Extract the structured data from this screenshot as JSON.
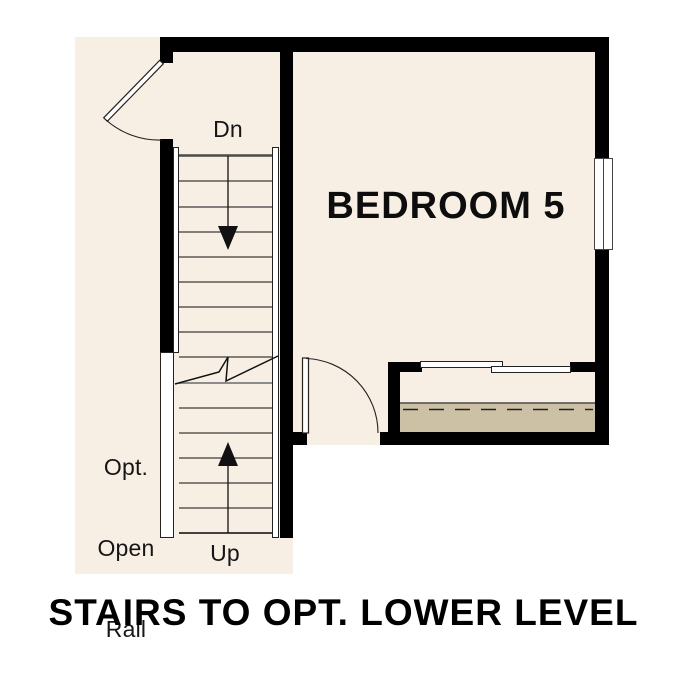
{
  "labels": {
    "bedroom": "BEDROOM 5",
    "down": "Dn",
    "up": "Up",
    "opt_rail": [
      "Opt.",
      "Open",
      "Rail"
    ],
    "caption": "STAIRS TO OPT. LOWER LEVEL"
  },
  "colors": {
    "floor": "#f7efe3",
    "shelf": "#cdc1a5",
    "wall": "#000000",
    "line": "#3c3c3c",
    "text": "#111111"
  }
}
